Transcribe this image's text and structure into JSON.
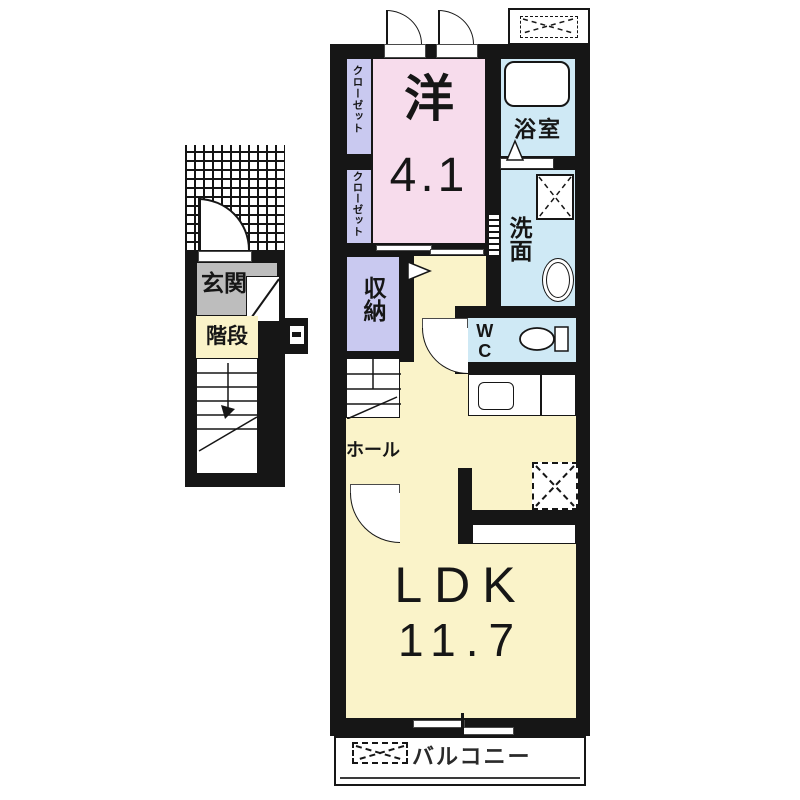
{
  "colors": {
    "wall": "#161616",
    "room_pink": "#f7dcec",
    "room_lavender": "#c9c9f0",
    "room_blue": "#cfe9f5",
    "room_yellow": "#faf3c9",
    "entrance_gray": "#bdbdbd"
  },
  "annex": {
    "entrance_label": "玄関",
    "stairs_label": "階段"
  },
  "main": {
    "closet1_label": "クローゼット",
    "closet2_label": "クローゼット",
    "western_room_name": "洋",
    "western_room_size": "4.1",
    "bath_label": "浴室",
    "washroom_label": "洗面",
    "storage_label": "収納",
    "wc_label": "WC",
    "hall_label": "ホール",
    "ldk_name": "LDK",
    "ldk_size": "11.7",
    "balcony_label": "バルコニー"
  }
}
